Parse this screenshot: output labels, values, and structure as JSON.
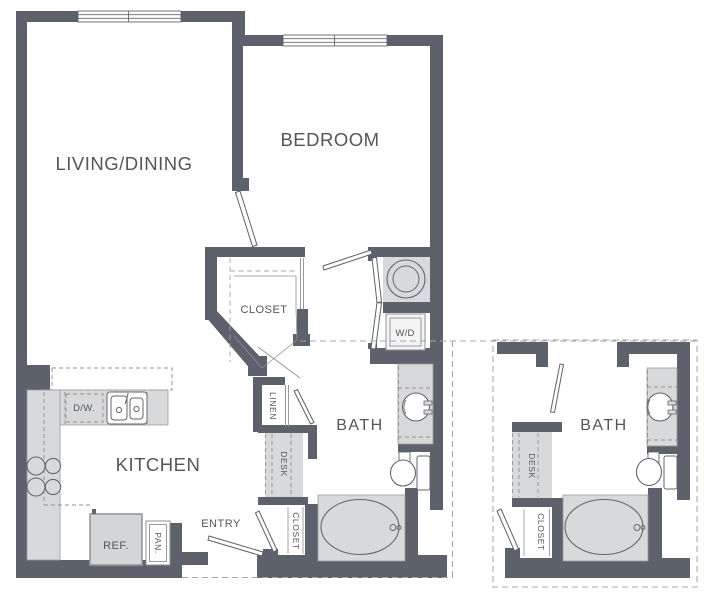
{
  "plan": {
    "type": "apartment-floor-plan",
    "colors": {
      "wall": "#5c616b",
      "fixture_fill": "#d8d9da",
      "fixture_stroke": "#64666d",
      "light_stroke": "#9a9b9e",
      "dashed_line": "#a4a5a8",
      "label_text": "#54565c",
      "background": "#ffffff"
    },
    "labels": {
      "living_dining": "LIVING/DINING",
      "bedroom": "BEDROOM",
      "closet": "CLOSET",
      "washer_dryer": "W/D",
      "linen": "LINEN",
      "desk": "DESK",
      "bath": "BATH",
      "bath_closet": "CLOSET",
      "kitchen": "KITCHEN",
      "dishwasher": "D/W.",
      "refrigerator": "REF.",
      "pantry": "PAN.",
      "entry": "ENTRY"
    },
    "inset_labels": {
      "bath": "BATH",
      "desk": "DESK",
      "closet": "CLOSET"
    }
  }
}
